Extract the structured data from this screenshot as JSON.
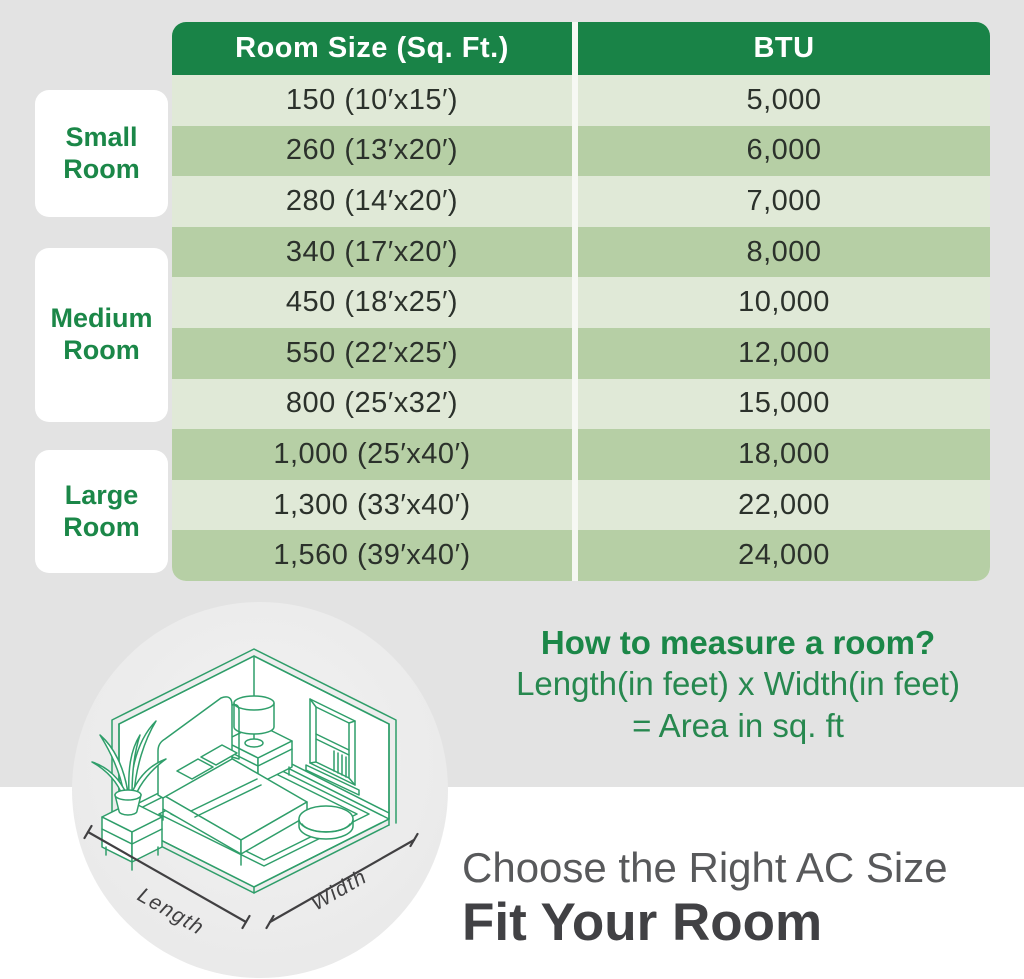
{
  "colors": {
    "bg_gray": "#e3e3e3",
    "header_bg": "#198347",
    "row_light": "#e0e9d7",
    "row_dark": "#b6cfa5",
    "label_green": "#1b8748",
    "line_art": "#2f9e6a",
    "dim_color": "#414042"
  },
  "chart_data": {
    "type": "table",
    "title": "Room Size (Sq. Ft.) to BTU",
    "columns": [
      "Room Size (Sq. Ft.)",
      "BTU"
    ],
    "groups": [
      {
        "label": "Small Room",
        "rows": [
          0,
          1,
          2
        ]
      },
      {
        "label": "Medium Room",
        "rows": [
          3,
          4,
          5,
          6
        ]
      },
      {
        "label": "Large Room",
        "rows": [
          7,
          8,
          9
        ]
      }
    ],
    "rows": [
      [
        "150 (10′x15′)",
        "5,000"
      ],
      [
        "260 (13′x20′)",
        "6,000"
      ],
      [
        "280 (14′x20′)",
        "7,000"
      ],
      [
        "340 (17′x20′)",
        "8,000"
      ],
      [
        "450 (18′x25′)",
        "10,000"
      ],
      [
        "550 (22′x25′)",
        "12,000"
      ],
      [
        "800 (25′x32′)",
        "15,000"
      ],
      [
        "1,000 (25′x40′)",
        "18,000"
      ],
      [
        "1,300 (33′x40′)",
        "22,000"
      ],
      [
        "1,560 (39′x40′)",
        "24,000"
      ]
    ]
  },
  "table": {
    "header": {
      "col1": "Room Size (Sq. Ft.)",
      "col2": "BTU"
    },
    "rows": [
      {
        "size": "150 (10′x15′)",
        "btu": "5,000"
      },
      {
        "size": "260 (13′x20′)",
        "btu": "6,000"
      },
      {
        "size": "280 (14′x20′)",
        "btu": "7,000"
      },
      {
        "size": "340 (17′x20′)",
        "btu": "8,000"
      },
      {
        "size": "450 (18′x25′)",
        "btu": "10,000"
      },
      {
        "size": "550 (22′x25′)",
        "btu": "12,000"
      },
      {
        "size": "800 (25′x32′)",
        "btu": "15,000"
      },
      {
        "size": "1,000 (25′x40′)",
        "btu": "18,000"
      },
      {
        "size": "1,300 (33′x40′)",
        "btu": "22,000"
      },
      {
        "size": "1,560 (39′x40′)",
        "btu": "24,000"
      }
    ]
  },
  "room_groups": [
    {
      "line1": "Small",
      "line2": "Room"
    },
    {
      "line1": "Medium",
      "line2": "Room"
    },
    {
      "line1": "Large",
      "line2": "Room"
    }
  ],
  "measure": {
    "title": "How to measure a room?",
    "formula_line1": "Length(in feet) x Width(in feet)",
    "formula_line2": "= Area in sq. ft"
  },
  "illustration": {
    "length_label": "Length",
    "width_label": "Width"
  },
  "footer": {
    "subtitle": "Choose the Right AC Size",
    "title": "Fit Your Room"
  }
}
